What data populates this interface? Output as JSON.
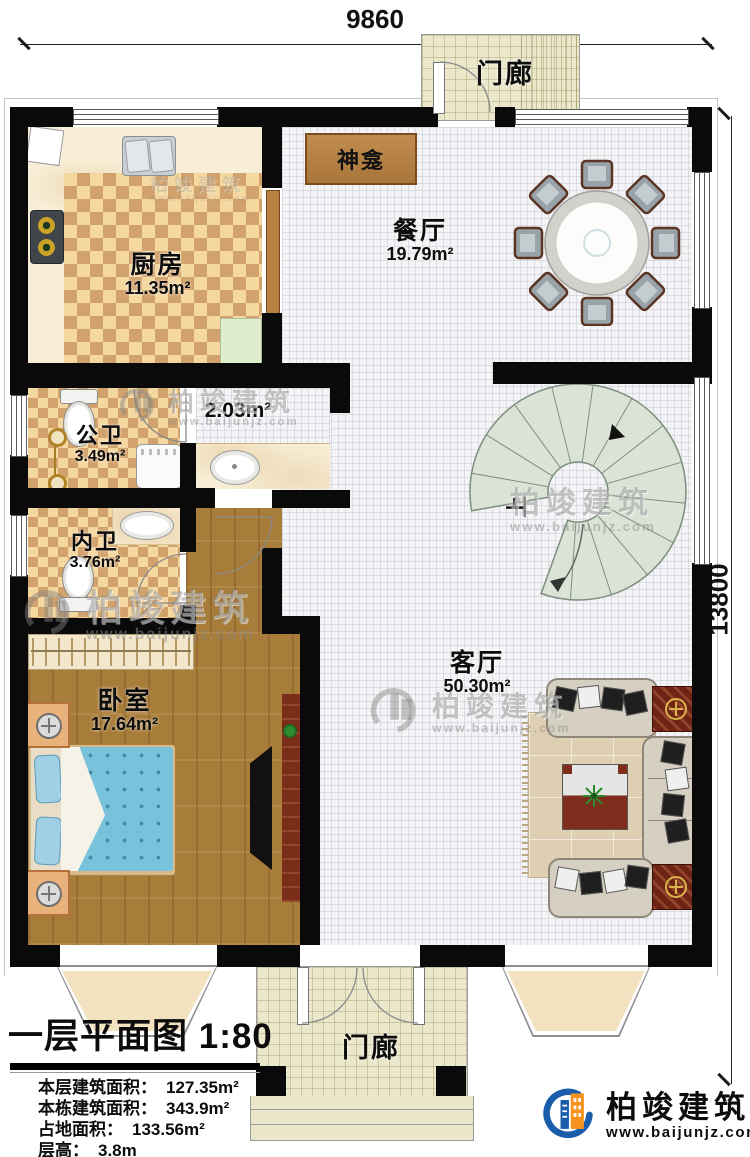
{
  "dimensions": {
    "width_label": "9860",
    "height_label": "13800"
  },
  "rooms": {
    "porch_top": {
      "label": "门廊"
    },
    "shrine": {
      "label": "神龛"
    },
    "dining": {
      "label": "餐厅",
      "area": "19.79m²"
    },
    "kitchen": {
      "label": "厨房",
      "area": "11.35m²"
    },
    "public_bath": {
      "label": "公卫",
      "area": "3.49m²"
    },
    "hallway": {
      "area": "2.03m²"
    },
    "ensuite_bath": {
      "label": "内卫",
      "area": "3.76m²"
    },
    "bedroom": {
      "label": "卧室",
      "area": "17.64m²"
    },
    "living": {
      "label": "客厅",
      "area": "50.30m²"
    },
    "stairs": {
      "label": "上"
    },
    "porch_bottom": {
      "label": "门廊"
    }
  },
  "title_block": {
    "title": "一层平面图 1:80",
    "rows": [
      {
        "label": "本层建筑面积：",
        "value": "127.35m²"
      },
      {
        "label": "本栋建筑面积：",
        "value": "343.9m²"
      },
      {
        "label": "占地面积：",
        "value": "133.56m²"
      },
      {
        "label": "层高：",
        "value": "3.8m"
      }
    ]
  },
  "brand": {
    "name": "柏竣建筑",
    "url": "www.baijunjz.com"
  },
  "watermark": {
    "name": "柏竣建筑",
    "url": "www.baijunjz.com"
  },
  "colors": {
    "wall": "#0a0a0a",
    "checker": "#d2a26c",
    "wood": "#a87c39",
    "stair": "#dbe3d7",
    "brand_blue": "#1a5dab",
    "brand_orange": "#f6921e"
  }
}
